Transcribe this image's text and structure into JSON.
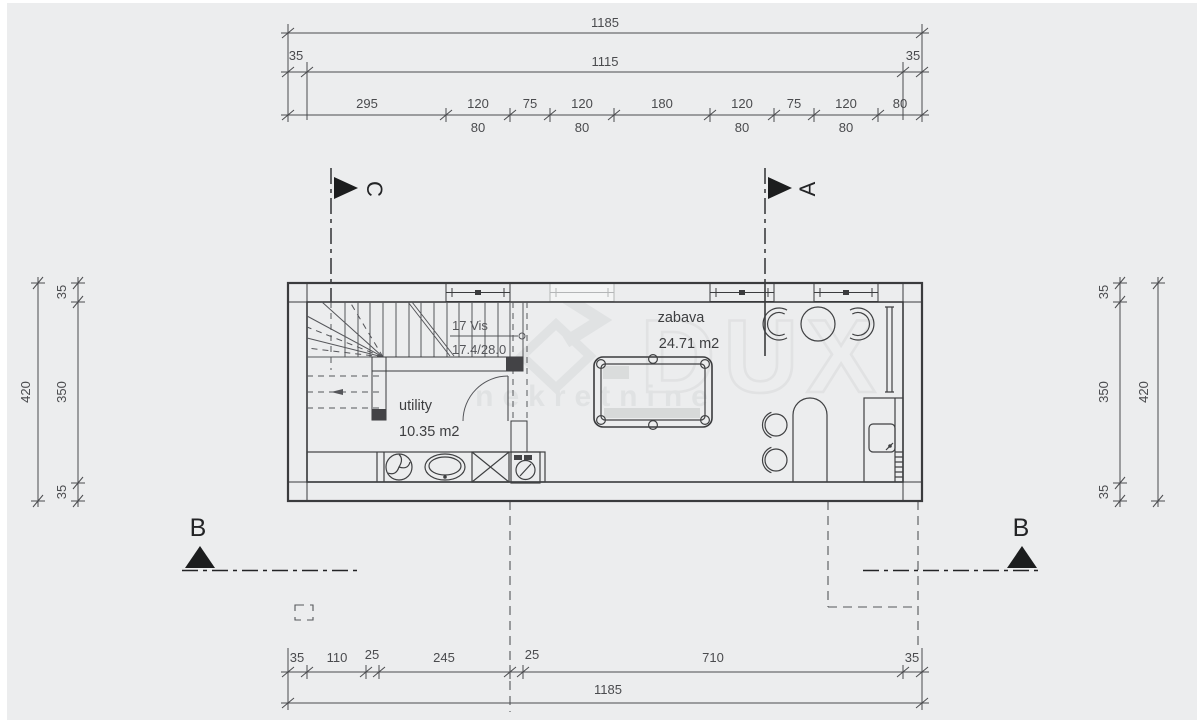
{
  "title": "floor plan drawing",
  "colors": {
    "background": "#ffffff",
    "canvas": "#ecedee",
    "line": "#3a3b3d",
    "dim": "#4a4b4e",
    "beam": "#c9cacb",
    "cap": "#434346",
    "wm": "#e0e2e3"
  },
  "watermark": {
    "logo": "DUX",
    "text": "nekretnine"
  },
  "sections": {
    "c": "C",
    "a": "A",
    "b_left": "B",
    "b_right": "B"
  },
  "rooms": {
    "stair": {
      "line1": "17 Vis",
      "line2": "17.4/28.0"
    },
    "utility": {
      "name": "utility",
      "area": "10.35 m2"
    },
    "zabava": {
      "name": "zabava",
      "area": "24.71 m2"
    }
  },
  "dims": {
    "top_total": "1185",
    "top_row2": {
      "left": "35",
      "mid": "1115",
      "right": "35"
    },
    "top_row3": [
      "295",
      "120",
      "75",
      "120",
      "180",
      "120",
      "75",
      "120",
      "80"
    ],
    "top_row3_sub": [
      "80",
      "80",
      "80",
      "80"
    ],
    "left": {
      "outer": "420",
      "inner": [
        "35",
        "350",
        "35"
      ]
    },
    "right": {
      "outer": "420",
      "inner": [
        "35",
        "350",
        "35"
      ]
    },
    "bottom_row1": [
      "35",
      "110",
      "25",
      "245",
      "25",
      "710",
      "35"
    ],
    "bottom_total": "1185"
  }
}
